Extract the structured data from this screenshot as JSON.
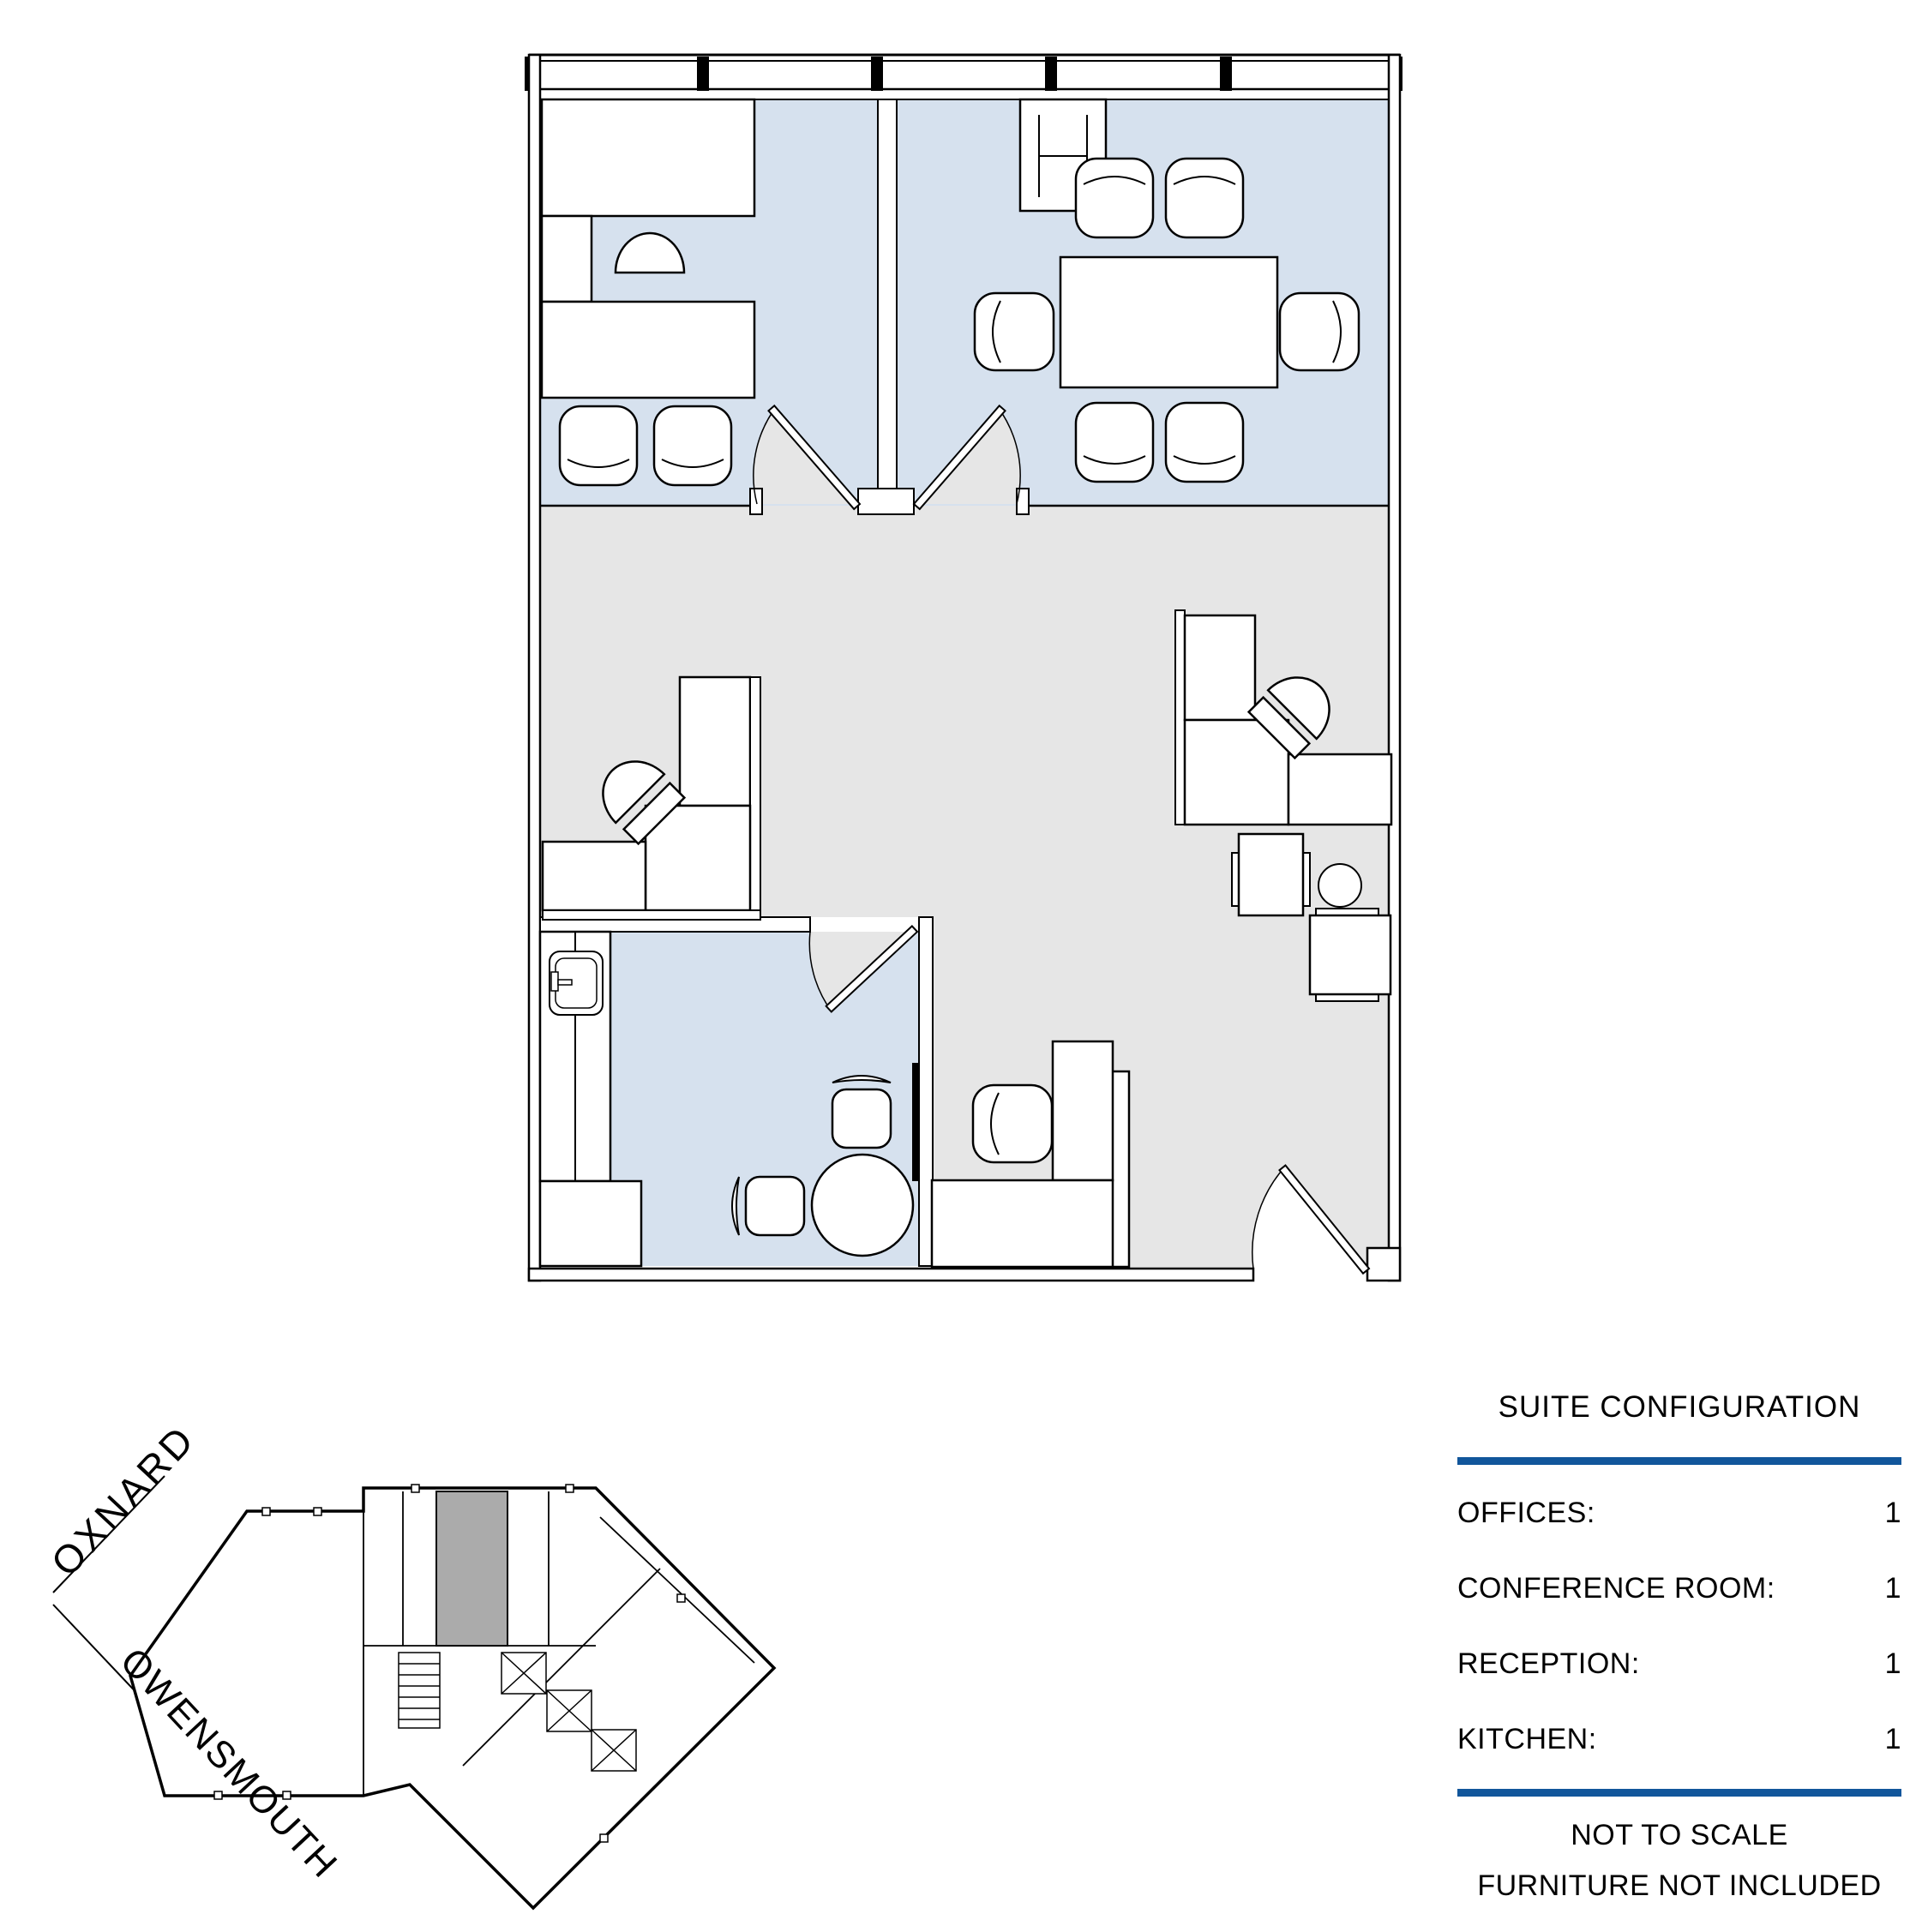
{
  "colors": {
    "room_fill_blue": "#D6E1EE",
    "floor_fill_gray": "#E6E6E6",
    "suite_highlight_gray": "#ABABAB",
    "accent_rule_blue": "#11569B",
    "line_black": "#000000",
    "mullion_black": "#000000"
  },
  "key_plan": {
    "street_label_1": "OXNARD",
    "street_label_2": "OWENSMOUTH"
  },
  "config_panel": {
    "title": "SUITE CONFIGURATION",
    "rows": [
      {
        "label": "OFFICES:",
        "value": "1"
      },
      {
        "label": "CONFERENCE ROOM:",
        "value": "1"
      },
      {
        "label": "RECEPTION:",
        "value": "1"
      },
      {
        "label": "KITCHEN:",
        "value": "1"
      }
    ],
    "notes": [
      "NOT TO SCALE",
      "FURNITURE NOT INCLUDED"
    ]
  }
}
